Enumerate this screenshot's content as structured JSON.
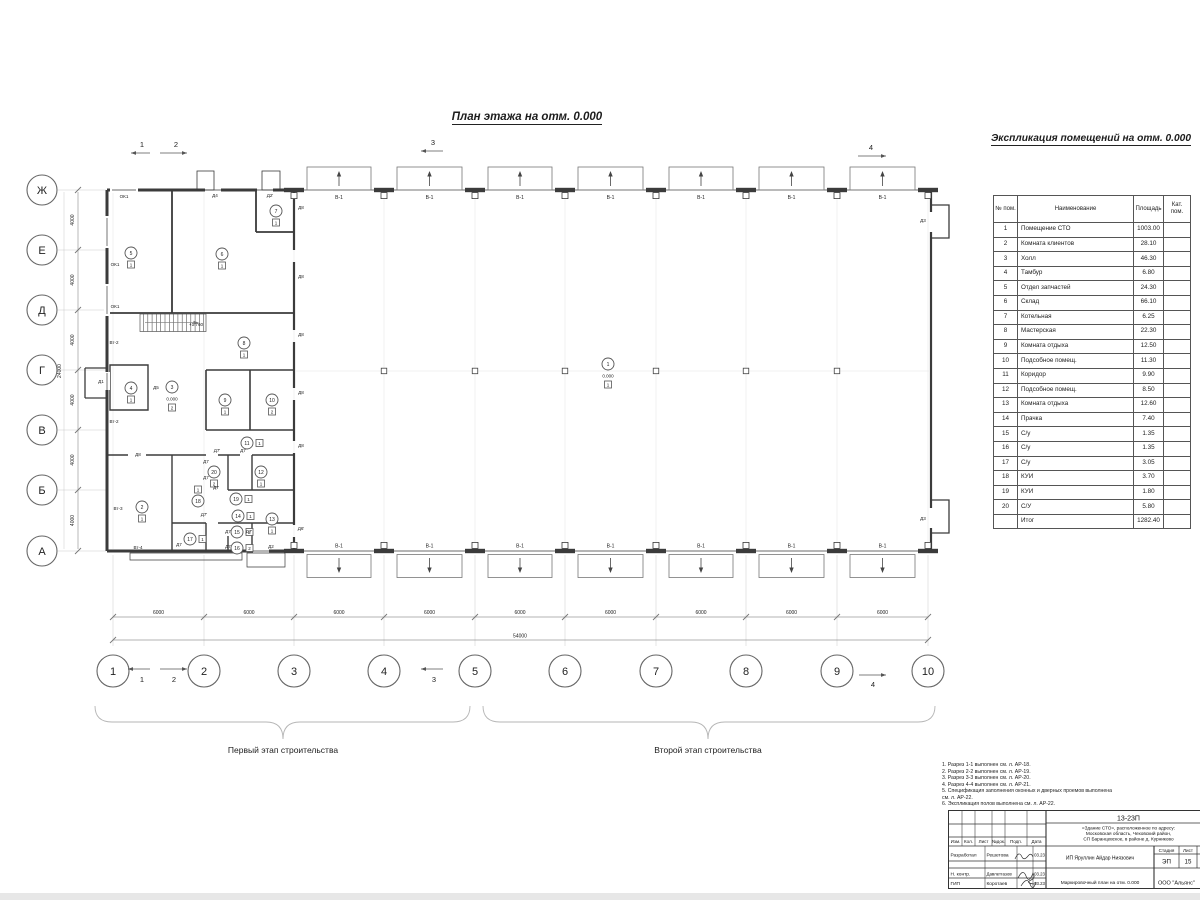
{
  "plan_title": "План этажа на отм. 0.000",
  "explication": {
    "title": "Экспликация помещений на отм. 0.000",
    "columns": {
      "num": "№ пом.",
      "name": "Наименование",
      "area": "Площадь",
      "cat": "Кат.\nпом."
    },
    "rows": [
      [
        "1",
        "Помещение СТО",
        "1003.00"
      ],
      [
        "2",
        "Комната клиентов",
        "28.10"
      ],
      [
        "3",
        "Холл",
        "46.30"
      ],
      [
        "4",
        "Тамбур",
        "6.80"
      ],
      [
        "5",
        "Отдел запчастей",
        "24.30"
      ],
      [
        "6",
        "Склад",
        "66.10"
      ],
      [
        "7",
        "Котельная",
        "6.25"
      ],
      [
        "8",
        "Мастерская",
        "22.30"
      ],
      [
        "9",
        "Комната отдыха",
        "12.50"
      ],
      [
        "10",
        "Подсобное помещ.",
        "11.30"
      ],
      [
        "11",
        "Коридор",
        "9.90"
      ],
      [
        "12",
        "Подсобное помещ.",
        "8.50"
      ],
      [
        "13",
        "Комната отдыха",
        "12.60"
      ],
      [
        "14",
        "Прачка",
        "7.40"
      ],
      [
        "15",
        "С/у",
        "1.35"
      ],
      [
        "16",
        "С/у",
        "1.35"
      ],
      [
        "17",
        "С/у",
        "3.05"
      ],
      [
        "18",
        "КУИ",
        "3.70"
      ],
      [
        "19",
        "КУИ",
        "1.80"
      ],
      [
        "20",
        "С/У",
        "5.80"
      ]
    ],
    "total": [
      "",
      "Итог",
      "1282.40"
    ]
  },
  "plan": {
    "axes_bottom": [
      "1",
      "2",
      "3",
      "4",
      "5",
      "6",
      "7",
      "8",
      "9",
      "10"
    ],
    "axes_left": [
      "Ж",
      "Е",
      "Д",
      "Г",
      "В",
      "Б",
      "А"
    ],
    "dim_bay": "6000",
    "dim_total_bottom": "54000",
    "dim_row": "4000",
    "dim_total_left": "24000",
    "gate_label": "В-1",
    "rooms": [
      {
        "n": "1",
        "x": 608,
        "y": 364,
        "f": "1",
        "p": "b",
        "l": "0.000"
      },
      {
        "n": "2",
        "x": 142,
        "y": 507,
        "f": "1",
        "p": "b"
      },
      {
        "n": "3",
        "x": 172,
        "y": 387,
        "f": "2",
        "p": "b",
        "l": "0.000"
      },
      {
        "n": "4",
        "x": 131,
        "y": 388,
        "f": "1",
        "p": "b"
      },
      {
        "n": "5",
        "x": 131,
        "y": 253,
        "f": "1",
        "p": "b"
      },
      {
        "n": "6",
        "x": 222,
        "y": 254,
        "f": "1",
        "p": "b"
      },
      {
        "n": "7",
        "x": 276,
        "y": 211,
        "f": "1",
        "p": "b"
      },
      {
        "n": "8",
        "x": 244,
        "y": 343,
        "f": "1",
        "p": "b"
      },
      {
        "n": "9",
        "x": 225,
        "y": 400,
        "f": "1",
        "p": "b"
      },
      {
        "n": "10",
        "x": 272,
        "y": 400,
        "f": "2",
        "p": "b"
      },
      {
        "n": "11",
        "x": 247,
        "y": 443,
        "f": "1",
        "p": "r"
      },
      {
        "n": "12",
        "x": 261,
        "y": 472,
        "f": "1",
        "p": "b"
      },
      {
        "n": "13",
        "x": 272,
        "y": 519,
        "f": "1",
        "p": "b"
      },
      {
        "n": "14",
        "x": 238,
        "y": 516,
        "f": "1",
        "p": "r"
      },
      {
        "n": "15",
        "x": 237,
        "y": 532,
        "f": "2",
        "p": "r"
      },
      {
        "n": "16",
        "x": 237,
        "y": 548,
        "f": "2",
        "p": "r"
      },
      {
        "n": "17",
        "x": 190,
        "y": 539,
        "f": "1",
        "p": "r"
      },
      {
        "n": "18",
        "x": 198,
        "y": 501,
        "f": "1",
        "p": "a"
      },
      {
        "n": "19",
        "x": 236,
        "y": 499,
        "f": "1",
        "p": "r"
      },
      {
        "n": "20",
        "x": 214,
        "y": 472,
        "f": "2",
        "p": "b"
      }
    ],
    "labels": [
      {
        "t": "ОК1",
        "x": 124,
        "y": 198
      },
      {
        "t": "ОК1",
        "x": 115,
        "y": 266
      },
      {
        "t": "ОК1",
        "x": 115,
        "y": 308
      },
      {
        "t": "Д4",
        "x": 215,
        "y": 197
      },
      {
        "t": "Д2'",
        "x": 270,
        "y": 197
      },
      {
        "t": "Д8",
        "x": 301,
        "y": 209
      },
      {
        "t": "Д8",
        "x": 301,
        "y": 278
      },
      {
        "t": "Д8",
        "x": 301,
        "y": 336
      },
      {
        "t": "Д8",
        "x": 301,
        "y": 394
      },
      {
        "t": "Д8",
        "x": 301,
        "y": 447
      },
      {
        "t": "Д6'",
        "x": 301,
        "y": 530
      },
      {
        "t": "Д1",
        "x": 101,
        "y": 383
      },
      {
        "t": "Д5",
        "x": 156,
        "y": 389
      },
      {
        "t": "Д3",
        "x": 923,
        "y": 222
      },
      {
        "t": "Д3",
        "x": 923,
        "y": 520
      },
      {
        "t": "Вт-2",
        "x": 114,
        "y": 344
      },
      {
        "t": "Вт-2",
        "x": 114,
        "y": 423
      },
      {
        "t": "Вт-3",
        "x": 118,
        "y": 510
      },
      {
        "t": "Вт-4",
        "x": 138,
        "y": 549
      },
      {
        "t": "Д8",
        "x": 138,
        "y": 456
      },
      {
        "t": "Д7'",
        "x": 217,
        "y": 452
      },
      {
        "t": "Д7",
        "x": 243,
        "y": 452
      },
      {
        "t": "Д7",
        "x": 206,
        "y": 463
      },
      {
        "t": "Д7",
        "x": 206,
        "y": 479
      },
      {
        "t": "Д7",
        "x": 216,
        "y": 489
      },
      {
        "t": "Д7'",
        "x": 204,
        "y": 516
      },
      {
        "t": "Д7",
        "x": 228,
        "y": 533
      },
      {
        "t": "Д7'",
        "x": 249,
        "y": 533
      },
      {
        "t": "Д7",
        "x": 179,
        "y": 546
      },
      {
        "t": "Д7",
        "x": 228,
        "y": 548
      },
      {
        "t": "Д2",
        "x": 271,
        "y": 548
      },
      {
        "t": "+1.760",
        "x": 196,
        "y": 326
      }
    ],
    "section_marks_top": [
      {
        "t": "1",
        "tx": 142,
        "ty": 147,
        "x1": 131,
        "x2": 150,
        "y": 153,
        "d": "l"
      },
      {
        "t": "2",
        "tx": 176,
        "ty": 147,
        "x1": 160,
        "x2": 187,
        "y": 153,
        "d": "r"
      },
      {
        "t": "3",
        "tx": 433,
        "ty": 145,
        "x1": 421,
        "x2": 443,
        "y": 151,
        "d": "l"
      },
      {
        "t": "4",
        "tx": 871,
        "ty": 150,
        "x1": 858,
        "x2": 886,
        "y": 156,
        "d": "r"
      }
    ],
    "section_marks_bottom": [
      {
        "t": "1",
        "tx": 142,
        "ty": 682,
        "x1": 128,
        "x2": 150,
        "y": 669,
        "d": "l"
      },
      {
        "t": "2",
        "tx": 174,
        "ty": 682,
        "x1": 160,
        "x2": 187,
        "y": 669,
        "d": "r"
      },
      {
        "t": "3",
        "tx": 434,
        "ty": 682,
        "x1": 421,
        "x2": 443,
        "y": 669,
        "d": "l"
      },
      {
        "t": "4",
        "tx": 873,
        "ty": 687,
        "x1": 859,
        "x2": 886,
        "y": 675,
        "d": "r"
      }
    ]
  },
  "stages": {
    "first": "Первый этап строительства",
    "second": "Второй этап строительства"
  },
  "notes": [
    "1. Разрез 1-1 выполнен см. л. АР-18.",
    "2. Разрез 2-2 выполнен см. л. АР-19.",
    "3. Разрез 3-3 выполнен см. л. АР-20.",
    "4. Разрез 4-4 выполнен см. л. АР-21.",
    "5. Спецификация заполнения оконных и дверных проемов выполнена см. л. АР-22.",
    "6. Экспликация полов выполнена см. л. АР-22."
  ],
  "titleblock": {
    "doc_number": "13-23П",
    "project_line1": "«Здание СТО», расположенное по адресу:",
    "project_line2": "Московская область, Чеховский район,",
    "project_line3": "СП Баранцевское, в районе д. Курниково",
    "columns": [
      "Изм.",
      "Кол.",
      "Лист",
      "№док.",
      "Подп.",
      "Дата"
    ],
    "row_developer": {
      "role": "Разработал",
      "name": "Решетова",
      "date": "03.23"
    },
    "row_ncontrol": {
      "role": "Н. контр.",
      "name": "Давлетгазов",
      "date": "03.23"
    },
    "row_gip": {
      "role": "ГИП",
      "name": "Коротаев",
      "date": "03.23"
    },
    "client": "ИП Яруллин Айдар Ниязович",
    "stage_label": "Стадия",
    "sheet_label": "Лист",
    "stage": "ЭП",
    "sheet": "15",
    "sheet_title": "Маркировочный план на отм. 0.000",
    "company": "ООО \"Альянс\""
  }
}
